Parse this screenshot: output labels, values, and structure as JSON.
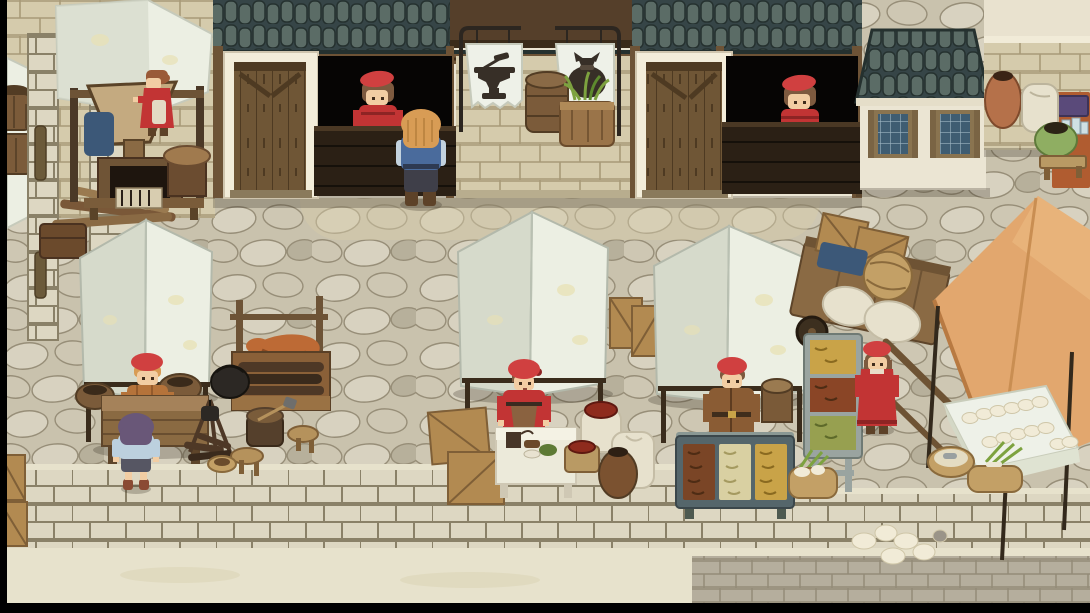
{
  "scene": {
    "description": "Hand-painted pixel-art RPG market square: shops with banner signs, white market tents, vendors and villagers on a cobblestone plaza above a stone wall",
    "setting": "medieval village market",
    "view": "top-down game viewport",
    "visible_text": ""
  },
  "signs": {
    "blacksmith_banner": {
      "icon": "anvil-icon",
      "meaning": "blacksmith shop"
    },
    "merchant_banner": {
      "icon": "money-bag-icon",
      "meaning": "general shop"
    }
  },
  "characters": [
    {
      "id": "mill-woman",
      "role": "villager at grain mill",
      "outfit": "red dress, light apron",
      "location": "top-left awning"
    },
    {
      "id": "shopkeeper-left",
      "role": "shopkeeper",
      "outfit": "red beret, red top",
      "location": "left shop counter"
    },
    {
      "id": "player",
      "role": "player character",
      "outfit": "blond hair, blue vest, dark pants",
      "location": "in front of left shop counter"
    },
    {
      "id": "shopkeeper-right",
      "role": "shopkeeper",
      "outfit": "red beret, red top",
      "location": "right shop counter"
    },
    {
      "id": "stall-vendor-left",
      "role": "market vendor",
      "outfit": "red cap, orange plaid coat",
      "location": "left tent stall"
    },
    {
      "id": "child-customer",
      "role": "child customer",
      "outfit": "purple hair, pale blue shirt",
      "location": "front of left stall table"
    },
    {
      "id": "stall-vendor-center",
      "role": "market vendor",
      "outfit": "red headscarf, red dress, brown apron",
      "location": "center tent stall"
    },
    {
      "id": "fish-vendor",
      "role": "fishmonger",
      "outfit": "red cap, long brown coat",
      "location": "fish stall under right tent"
    },
    {
      "id": "walking-woman",
      "role": "villager",
      "outfit": "red hat, long red dress",
      "location": "right of fish stall"
    }
  ],
  "props": [
    "grain-mill",
    "white-market-tent-x3",
    "roast-spit-with-meat",
    "hand-cart",
    "orange-canopy",
    "egg-table",
    "fish-display-case",
    "fish-rack",
    "spice-sacks",
    "clay-jar",
    "wooden-crates",
    "barrels",
    "campfire-with-kettle",
    "tree-stump-with-axe",
    "stools",
    "baskets-with-greens",
    "urn",
    "green-pot",
    "bench"
  ],
  "palette": {
    "plaza_base": "#c9c2ad",
    "stone_light": "#d8d2c0",
    "stone_mid": "#cec7b3",
    "stone_dark": "#b7b09b",
    "stone_line": "#978e78",
    "wall_block": "#ddd7c2",
    "wall_mortar": "#8a8168",
    "band_light": "#e7e2cc",
    "paver_gray": "#b5ae9d",
    "paver_line": "#938b78",
    "plaster": "#ebe5d3",
    "plaster_light": "#f3edda",
    "brick_beige": "#d5cbac",
    "brick_line": "#a89a78",
    "timber_dark": "#4b3927",
    "timber_mid": "#6d5336",
    "door_wood": "#6f5636",
    "door_line": "#4e3a22",
    "opening_black": "#060504",
    "counter_wood": "#2b2015",
    "counter_line": "#15100a",
    "roof_bg": "#364547",
    "roof_tile": "#5b6c66",
    "roof_line": "#25312f",
    "pane_blue": "#3f5d72",
    "pane_line": "#9db6c2",
    "banner_white": "#eef1e8",
    "banner_edge": "#c6cabb",
    "icon_dark": "#372f27",
    "iron_dark": "#2c2620",
    "canopy_white": "#ecefe3",
    "canopy_shade": "#d6dacb",
    "canopy_spot": "#e8e1b4",
    "orange_canopy": "#e2a76e",
    "orange_shade": "#c98e52",
    "crate": "#b28a51",
    "crate_dark": "#7f5f37",
    "barrel": "#7b5b3a",
    "barrel_dark": "#523c24",
    "sack": "#e7e1cd",
    "spice_red": "#8e2b1d",
    "cart_wood": "#8a6a44",
    "meat": "#bd6a35",
    "meat_dark": "#8e4a20",
    "fire_wood": "#4e3826",
    "skin": "#f2cda3",
    "hair_blond": "#d89c55",
    "hair_brown": "#7d5a3f",
    "hair_red_brown": "#9a5a38",
    "hair_purple": "#695778",
    "red_outfit": "#c23434",
    "red_dark": "#8e2424",
    "hat_red": "#d04040",
    "vest_blue": "#4a6b9c",
    "shirt_blue": "#c3d2de",
    "pants_dark": "#3f3f49",
    "boots_brown": "#5d4228",
    "coat_orange": "#b5733a",
    "coat_brown": "#8a5c34",
    "apron_brown": "#8a6240",
    "kid_shirt": "#bcd0de",
    "fish_gold": "#c9a348",
    "fish_pale": "#d9d0a2",
    "fish_brown": "#7a4526",
    "fish_green": "#97a050",
    "tray_frame": "#55666b",
    "rack_gray": "#9aa4a0",
    "basket": "#c3a066",
    "basket_dark": "#8a6a3c",
    "egg_white": "#f1ebd7",
    "grass_green": "#7da23f",
    "pot_green": "#8fae62",
    "urn_clay": "#b5714a",
    "mat_rust": "#b05c30",
    "box_purple": "#5a4a7a",
    "cloth_blue": "#3c5878"
  }
}
